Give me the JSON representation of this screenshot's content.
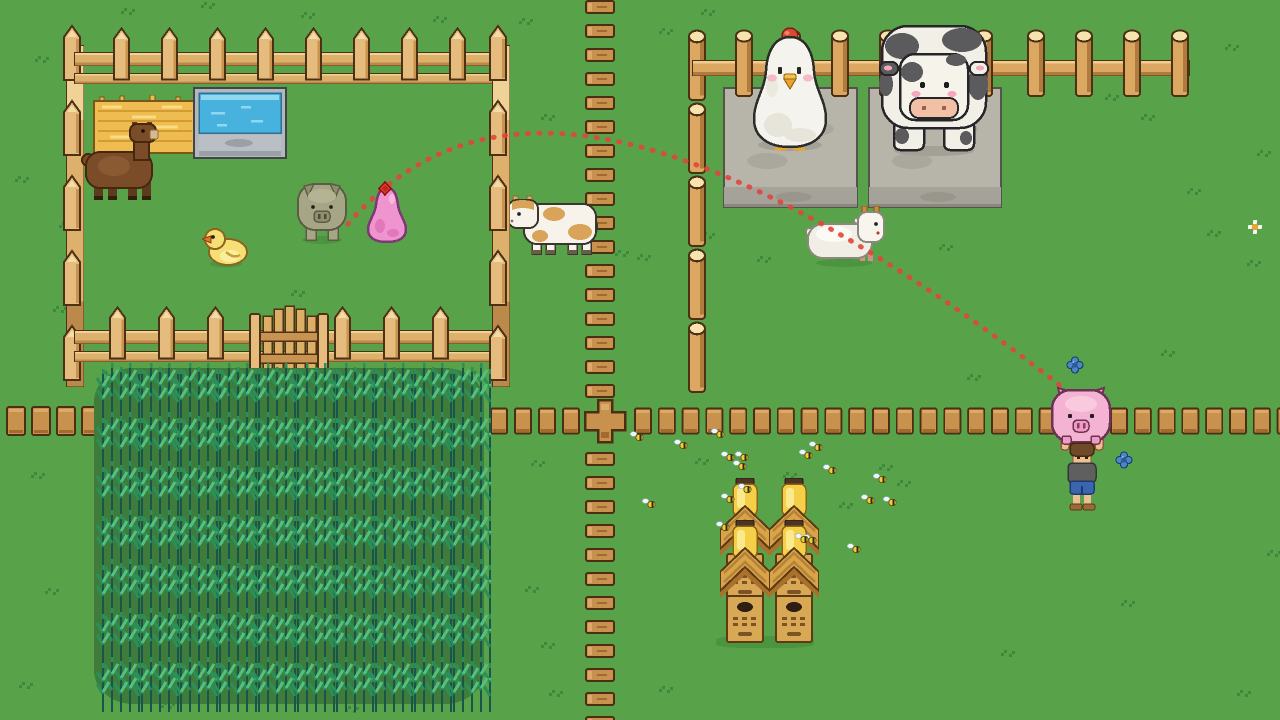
{
  "scene": {
    "width": 1280,
    "height": 720,
    "colors": {
      "grass": "#58a34a",
      "grass_tuft": "#3c8a3e",
      "fence_wood": "#e5bc7d",
      "plank_wood": "#c8914e",
      "log_wood": "#dca861",
      "stone": "#b7b4aa",
      "water": "#47b2dd",
      "hay": "#eebc50",
      "crop_green": "#2a8f58",
      "trajectory_red": "#e2453c",
      "marker_red": "#e03a2e",
      "pig_pink": "#f4b3d3",
      "slime_pink": "#ef94cf"
    },
    "trajectory": {
      "name": "throw-arc",
      "path": "M348,224 C480,70 700,100 1085,405",
      "color": "#e2453c",
      "width": 5,
      "dash": "1 10.5",
      "linecap": "round",
      "opacity": 0.9
    },
    "entities": [
      {
        "name": "grass-tuft",
        "sprite": "grass-tuft",
        "w": 16,
        "h": 10,
        "interactable": false,
        "points": [
          [
            120,
            6
          ],
          [
            200,
            0
          ],
          [
            300,
            10
          ],
          [
            432,
            14
          ],
          [
            518,
            16
          ],
          [
            34,
            54
          ],
          [
            256,
            92
          ],
          [
            540,
            112
          ],
          [
            658,
            26
          ],
          [
            700,
            7
          ],
          [
            962,
            52
          ],
          [
            1104,
            92
          ],
          [
            1224,
            42
          ],
          [
            1140,
            112
          ],
          [
            1256,
            148
          ],
          [
            892,
            132
          ],
          [
            614,
            248
          ],
          [
            636,
            252
          ],
          [
            700,
            230
          ],
          [
            756,
            254
          ],
          [
            14,
            174
          ],
          [
            58,
            220
          ],
          [
            290,
            288
          ],
          [
            52,
            304
          ],
          [
            1186,
            186
          ],
          [
            1206,
            228
          ],
          [
            1246,
            258
          ],
          [
            938,
            242
          ],
          [
            1160,
            348
          ],
          [
            966,
            372
          ],
          [
            878,
            462
          ],
          [
            896,
            478
          ],
          [
            838,
            500
          ],
          [
            694,
            456
          ],
          [
            530,
            458
          ],
          [
            524,
            584
          ],
          [
            540,
            640
          ],
          [
            56,
            416
          ],
          [
            30,
            470
          ],
          [
            44,
            586
          ],
          [
            18,
            680
          ],
          [
            1120,
            598
          ],
          [
            1000,
            648
          ],
          [
            1236,
            688
          ],
          [
            1266,
            548
          ],
          [
            160,
            700
          ],
          [
            344,
            704
          ],
          [
            548,
            688
          ],
          [
            658,
            684
          ],
          [
            782,
            470
          ]
        ]
      },
      {
        "name": "daisy-flower",
        "sprite": "daisy",
        "w": 14,
        "h": 14,
        "interactable": false,
        "points": [
          [
            1248,
            220
          ]
        ]
      },
      {
        "name": "blue-flower",
        "sprite": "flower-blue",
        "w": 18,
        "h": 18,
        "interactable": false,
        "points": [
          [
            1066,
            356
          ],
          [
            1115,
            451
          ]
        ]
      },
      {
        "name": "chicken-statue-pedestal",
        "sprite": "stone-platform",
        "x": 723,
        "y": 87,
        "w": 135,
        "h": 121,
        "interactable": false
      },
      {
        "name": "cow-statue-pedestal",
        "sprite": "stone-platform",
        "x": 868,
        "y": 87,
        "w": 134,
        "h": 121,
        "interactable": false
      },
      {
        "name": "hay-feeder",
        "sprite": "hay",
        "x": 92,
        "y": 95,
        "w": 106,
        "h": 62,
        "interactable": true
      },
      {
        "name": "water-trough",
        "sprite": "trough",
        "x": 193,
        "y": 87,
        "w": 94,
        "h": 73,
        "interactable": true
      },
      {
        "name": "plank-path-column-upper",
        "sprite": "plank-h",
        "x": 585,
        "y": 0,
        "w": 30,
        "h": 14,
        "interactable": false,
        "repeat": {
          "count": 17,
          "dx": 0,
          "dy": 24
        }
      },
      {
        "name": "cow-calf",
        "sprite": "cow-calf",
        "x": 506,
        "y": 194,
        "w": 94,
        "h": 64,
        "interactable": true
      },
      {
        "name": "pen-left-fence-rail",
        "sprite": "rail",
        "x": 66,
        "y": 45,
        "w": 18,
        "h": 342,
        "interactable": false
      },
      {
        "name": "pen-left-fence-picket",
        "sprite": "picket",
        "x": 62,
        "y": 24,
        "w": 20,
        "h": 58,
        "interactable": false,
        "repeat": {
          "count": 5,
          "dx": 0,
          "dy": 75
        }
      },
      {
        "name": "pen-top-fence-rail",
        "sprite": "rail",
        "x": 74,
        "y": 52,
        "w": 432,
        "h": 14,
        "interactable": false
      },
      {
        "name": "pen-top-fence-rail",
        "sprite": "rail",
        "x": 74,
        "y": 73,
        "w": 432,
        "h": 11,
        "interactable": false
      },
      {
        "name": "pen-top-fence-picket",
        "sprite": "picket",
        "x": 112,
        "y": 26,
        "w": 19,
        "h": 56,
        "interactable": false,
        "repeat": {
          "count": 8,
          "dx": 48,
          "dy": 0
        }
      },
      {
        "name": "pen-bottom-fence-rail",
        "sprite": "rail",
        "x": 74,
        "y": 330,
        "w": 432,
        "h": 14,
        "interactable": false
      },
      {
        "name": "pen-bottom-fence-rail",
        "sprite": "rail",
        "x": 74,
        "y": 351,
        "w": 432,
        "h": 11,
        "interactable": false
      },
      {
        "name": "pen-bottom-fence-picket",
        "sprite": "picket",
        "x": 108,
        "y": 305,
        "w": 19,
        "h": 56,
        "interactable": false,
        "repeat": {
          "count": 3,
          "dx": 49,
          "dy": 0
        }
      },
      {
        "name": "pen-bottom-fence-picket",
        "sprite": "picket",
        "x": 333,
        "y": 305,
        "w": 19,
        "h": 56,
        "interactable": false,
        "repeat": {
          "count": 3,
          "dx": 49,
          "dy": 0
        }
      },
      {
        "name": "pen-right-fence-rail",
        "sprite": "rail",
        "x": 492,
        "y": 45,
        "w": 18,
        "h": 342,
        "interactable": false
      },
      {
        "name": "pen-right-fence-picket",
        "sprite": "picket",
        "x": 488,
        "y": 24,
        "w": 20,
        "h": 58,
        "interactable": false,
        "repeat": {
          "count": 5,
          "dx": 0,
          "dy": 75
        }
      },
      {
        "name": "pen-gate",
        "sprite": "gate",
        "x": 248,
        "y": 302,
        "w": 82,
        "h": 80,
        "interactable": true
      },
      {
        "name": "plank-fence-cross-junction",
        "sprite": "plank-cross",
        "x": 583,
        "y": 398,
        "w": 44,
        "h": 46,
        "interactable": false
      },
      {
        "name": "plank-path-column-lower",
        "sprite": "plank-h",
        "x": 585,
        "y": 452,
        "w": 30,
        "h": 14,
        "interactable": false,
        "repeat": {
          "count": 12,
          "dx": 0,
          "dy": 24
        }
      },
      {
        "name": "plank-fence-post",
        "sprite": "plank-v",
        "x": 6,
        "y": 406,
        "w": 20,
        "h": 30,
        "interactable": false,
        "repeat": {
          "count": 4,
          "dx": 25,
          "dy": 0
        }
      },
      {
        "name": "plank-fence-post",
        "sprite": "plank-v",
        "x": 490,
        "y": 406,
        "w": 18,
        "h": 30,
        "interactable": false,
        "repeat": {
          "count": 4,
          "dx": 24,
          "dy": 0
        }
      },
      {
        "name": "plank-fence-post",
        "sprite": "plank-v",
        "x": 634,
        "y": 406,
        "w": 18,
        "h": 30,
        "interactable": false,
        "repeat": {
          "count": 28,
          "dx": 23.8,
          "dy": 0
        }
      },
      {
        "name": "log-fence-pole-segment",
        "sprite": "log-post",
        "x": 686,
        "y": 28,
        "w": 22,
        "h": 74,
        "interactable": false,
        "repeat": {
          "count": 5,
          "dx": 0,
          "dy": 73
        }
      },
      {
        "name": "log-fence-rail",
        "sprite": "log-rail",
        "x": 692,
        "y": 60,
        "w": 498,
        "h": 16,
        "interactable": false
      },
      {
        "name": "log-fence-post",
        "sprite": "log-post",
        "w": 22,
        "h": 70,
        "interactable": false,
        "points": [
          [
            733,
            28
          ],
          [
            781,
            28
          ],
          [
            829,
            28
          ],
          [
            877,
            28
          ],
          [
            925,
            28
          ],
          [
            973,
            28
          ],
          [
            1025,
            28
          ],
          [
            1073,
            28
          ],
          [
            1121,
            28
          ],
          [
            1169,
            28
          ]
        ]
      },
      {
        "name": "crop-field-bed",
        "sprite": "field-bed",
        "x": 94,
        "y": 368,
        "w": 390,
        "h": 336,
        "interactable": false
      },
      {
        "name": "crop-stalks",
        "sprite": "crop-tile",
        "x": 96,
        "y": 360,
        "w": 44,
        "h": 58,
        "interactable": true,
        "grid": {
          "cols": 10,
          "rows": 7,
          "dx": 39,
          "dy": 49
        }
      },
      {
        "name": "giant-chicken-statue",
        "sprite": "chicken-statue",
        "x": 745,
        "y": 27,
        "w": 90,
        "h": 127,
        "interactable": true
      },
      {
        "name": "giant-cow-statue",
        "sprite": "cow-statue",
        "x": 878,
        "y": 24,
        "w": 112,
        "h": 132,
        "interactable": true
      },
      {
        "name": "alpaca",
        "sprite": "alpaca",
        "x": 80,
        "y": 122,
        "w": 84,
        "h": 84,
        "interactable": true
      },
      {
        "name": "duckling",
        "sprite": "duck",
        "x": 202,
        "y": 228,
        "w": 48,
        "h": 40,
        "interactable": true
      },
      {
        "name": "gray-pig",
        "sprite": "pig-gray",
        "x": 294,
        "y": 182,
        "w": 56,
        "h": 64,
        "interactable": true
      },
      {
        "name": "white-goat",
        "sprite": "goat",
        "x": 804,
        "y": 206,
        "w": 88,
        "h": 62,
        "interactable": true
      },
      {
        "name": "beehive-shadow",
        "sprite": "shade",
        "x": 716,
        "y": 636,
        "w": 98,
        "h": 12,
        "interactable": false
      },
      {
        "name": "beehive",
        "sprite": "beehive",
        "w": 50,
        "h": 126,
        "interactable": true,
        "points": [
          [
            720,
            478
          ],
          [
            769,
            478
          ]
        ]
      },
      {
        "name": "beehive",
        "sprite": "beehive",
        "w": 50,
        "h": 126,
        "interactable": true,
        "points": [
          [
            720,
            520
          ],
          [
            769,
            520
          ]
        ]
      },
      {
        "name": "bee",
        "sprite": "bee",
        "w": 14,
        "h": 11,
        "interactable": false,
        "points": [
          [
            630,
            431
          ],
          [
            674,
            439
          ],
          [
            711,
            428
          ],
          [
            721,
            451
          ],
          [
            735,
            451
          ],
          [
            733,
            460
          ],
          [
            799,
            449
          ],
          [
            809,
            441
          ],
          [
            823,
            464
          ],
          [
            873,
            473
          ],
          [
            861,
            494
          ],
          [
            883,
            496
          ],
          [
            642,
            498
          ],
          [
            738,
            483
          ],
          [
            721,
            493
          ],
          [
            803,
            534
          ],
          [
            847,
            543
          ],
          [
            716,
            521
          ],
          [
            795,
            533
          ]
        ]
      },
      {
        "name": "pink-slime",
        "sprite": "blob-pink",
        "x": 364,
        "y": 186,
        "w": 46,
        "h": 58,
        "layer": "above",
        "interactable": true
      },
      {
        "name": "target-marker",
        "sprite": "marker",
        "x": 378,
        "y": 181,
        "w": 14,
        "h": 15,
        "layer": "above",
        "interactable": false
      },
      {
        "name": "player-carrying-pig",
        "sprite": "player-pig",
        "x": 1050,
        "y": 386,
        "w": 64,
        "h": 128,
        "layer": "above",
        "interactable": true
      }
    ]
  }
}
